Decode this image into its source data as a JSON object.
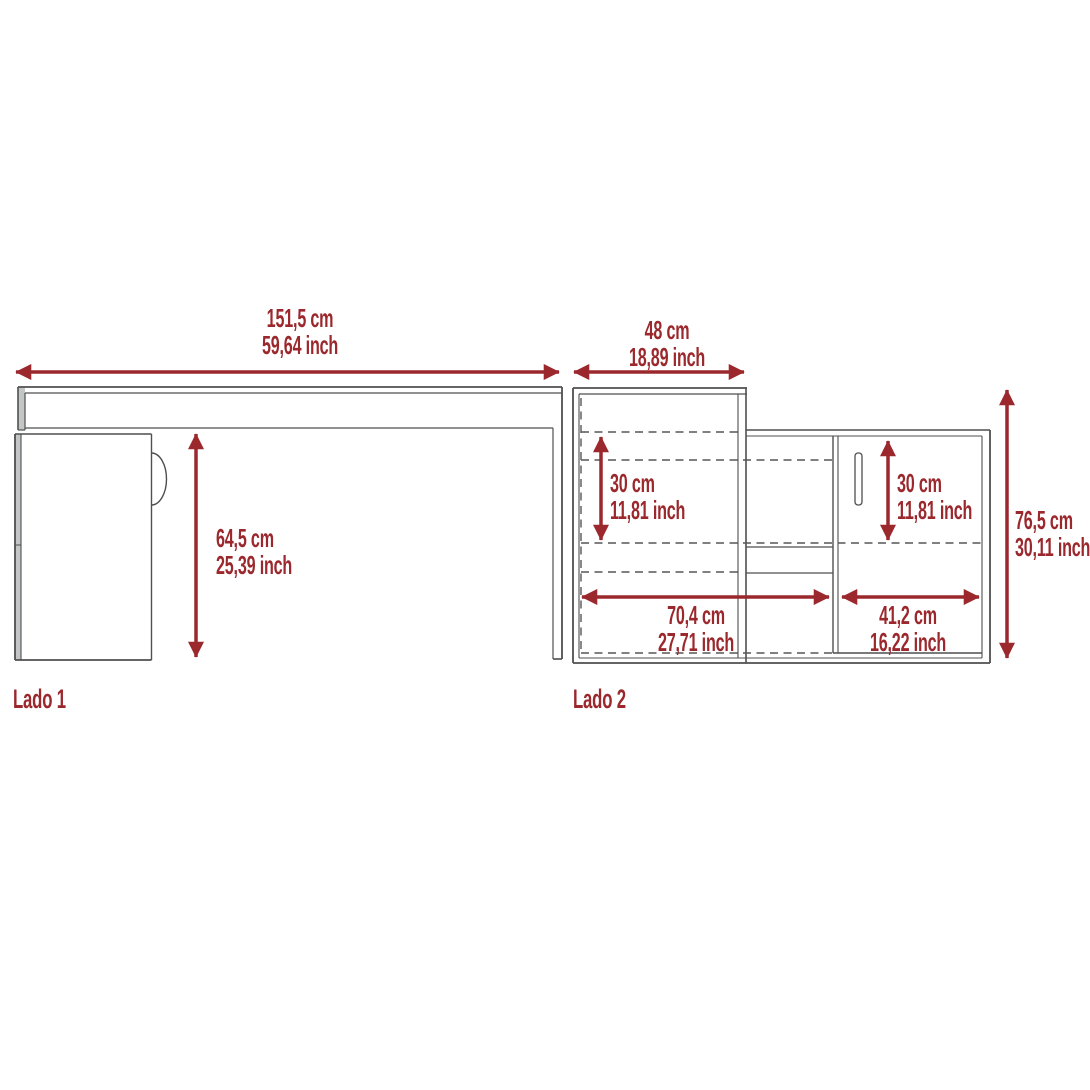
{
  "page": {
    "type": "furniture-dimension-diagram",
    "background": "#ffffff"
  },
  "colors": {
    "dimension_red": "#9b282d",
    "line_gray": "#4f4f4f",
    "panel_fill": "#c3c6c6"
  },
  "side1": {
    "label": "Lado 1",
    "width_cm": "151,5 cm",
    "width_inch": "59,64 inch",
    "height_cm": "64,5 cm",
    "height_inch": "25,39 inch"
  },
  "side2": {
    "label": "Lado 2",
    "top_depth_cm": "48 cm",
    "top_depth_inch": "18,89 inch",
    "left_shelf_cm": "30 cm",
    "left_shelf_inch": "11,81 inch",
    "right_shelf_cm": "30 cm",
    "right_shelf_inch": "11,81 inch",
    "lower_left_cm": "70,4 cm",
    "lower_left_inch": "27,71 inch",
    "lower_right_cm": "41,2 cm",
    "lower_right_inch": "16,22 inch",
    "height_cm": "76,5 cm",
    "height_inch": "30,11 inch"
  }
}
